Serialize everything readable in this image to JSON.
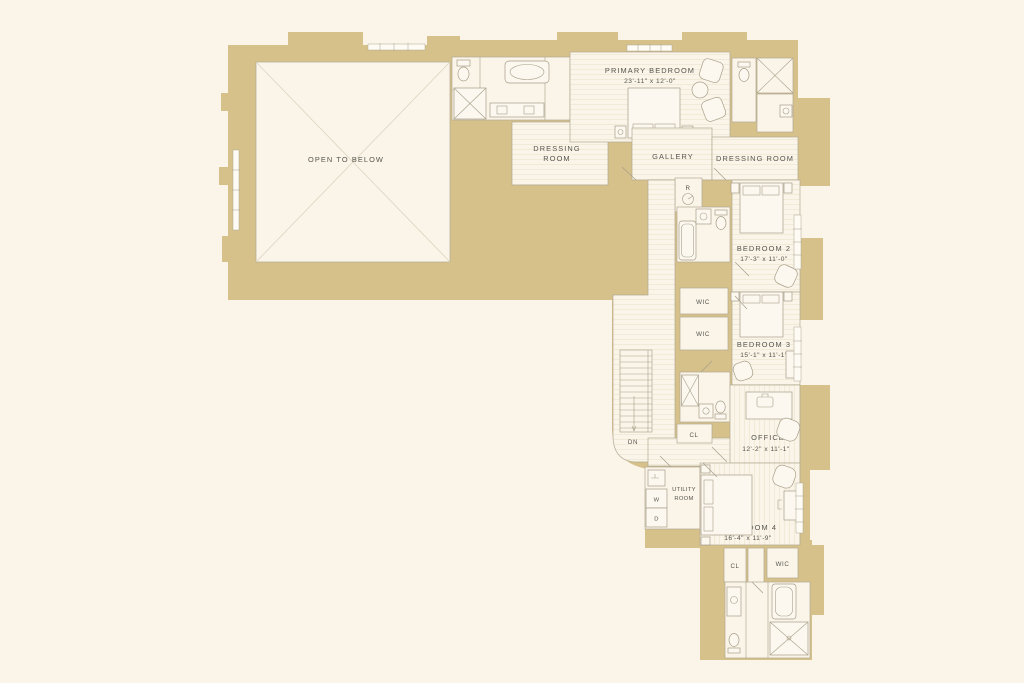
{
  "palette": {
    "background": "#FBF4E9",
    "wall_fill": "#D5C189",
    "room_fill": "#FAF5E8",
    "line_color": "#A89F8A",
    "text_color": "#57554F"
  },
  "rooms": {
    "open_to_below": {
      "label": "OPEN TO BELOW"
    },
    "primary_bedroom": {
      "label": "PRIMARY BEDROOM",
      "dims": "23'-11\" x 12'-0\""
    },
    "dressing_room_left": {
      "label_line1": "DRESSING",
      "label_line2": "ROOM"
    },
    "gallery": {
      "label": "GALLERY"
    },
    "dressing_room_right": {
      "label": "DRESSING ROOM"
    },
    "bedroom_2": {
      "label": "BEDROOM 2",
      "dims": "17'-3\" x 11'-0\""
    },
    "wic_upper": {
      "label": "WIC"
    },
    "wic_lower": {
      "label": "WIC"
    },
    "bedroom_3": {
      "label": "BEDROOM 3",
      "dims": "15'-1\" x 11'-1\""
    },
    "office": {
      "label": "OFFICE",
      "dims": "12'-2\" x 11'-1\""
    },
    "closet_office": {
      "label": "CL"
    },
    "utility_room": {
      "label_line1": "UTILITY",
      "label_line2": "ROOM"
    },
    "washer": {
      "label": "W"
    },
    "dryer": {
      "label": "D"
    },
    "bedroom_4": {
      "label": "BEDROOM 4",
      "dims": "16'-4\" x 11'-9\""
    },
    "closet_bottom": {
      "label": "CL"
    },
    "wic_bottom": {
      "label": "WIC"
    },
    "riser_closet": {
      "label": "R"
    },
    "stairs": {
      "label": "DN"
    }
  }
}
